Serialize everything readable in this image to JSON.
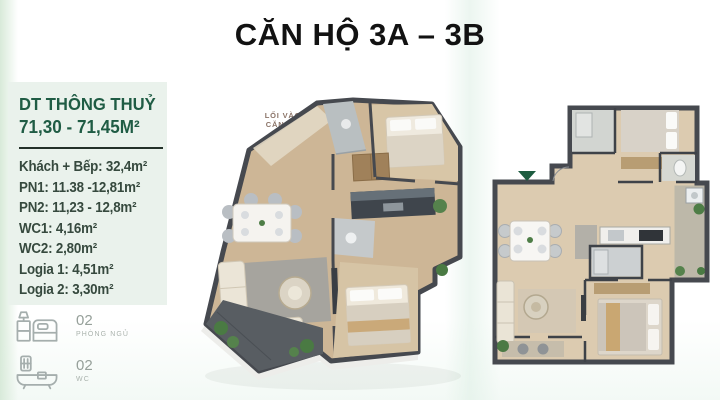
{
  "title": "CĂN HỘ 3A – 3B",
  "specs_panel": {
    "heading": "DT THÔNG THUỶ",
    "area_range": "71,30 - 71,45M²",
    "rooms": [
      "Khách + Bếp: 32,4m²",
      "PN1: 11.38 -12,81m²",
      "PN2: 11,23 - 12,8m²",
      "WC1: 4,16m²",
      "WC2: 2,80m²",
      "Logia 1: 4,51m²",
      "Logia 2: 3,30m²"
    ],
    "stats": [
      {
        "icon": "bed-icon",
        "count": "02",
        "label": "PHÒNG NGỦ"
      },
      {
        "icon": "bathtub-icon",
        "count": "02",
        "label": "WC"
      }
    ]
  },
  "plan_3d": {
    "entrance_label": {
      "line1": "LỐI VÀO",
      "line2": "CĂN HỘ"
    }
  },
  "colors": {
    "title_text": "#121212",
    "panel_bg": "#eaf2ec",
    "heading_green": "#1f5c44",
    "room_text": "#36493e",
    "divider": "#233129",
    "stat_text": "#96a09a",
    "stat_icon": "#a5aead",
    "entrance_text": "#8b7468",
    "entrance_arrow": "#7a1e2a",
    "marker_green": "#1d5c40",
    "wall_dark": "#46494f",
    "floor_wood": "#cdb696",
    "floor_beige": "#dccbb0"
  }
}
